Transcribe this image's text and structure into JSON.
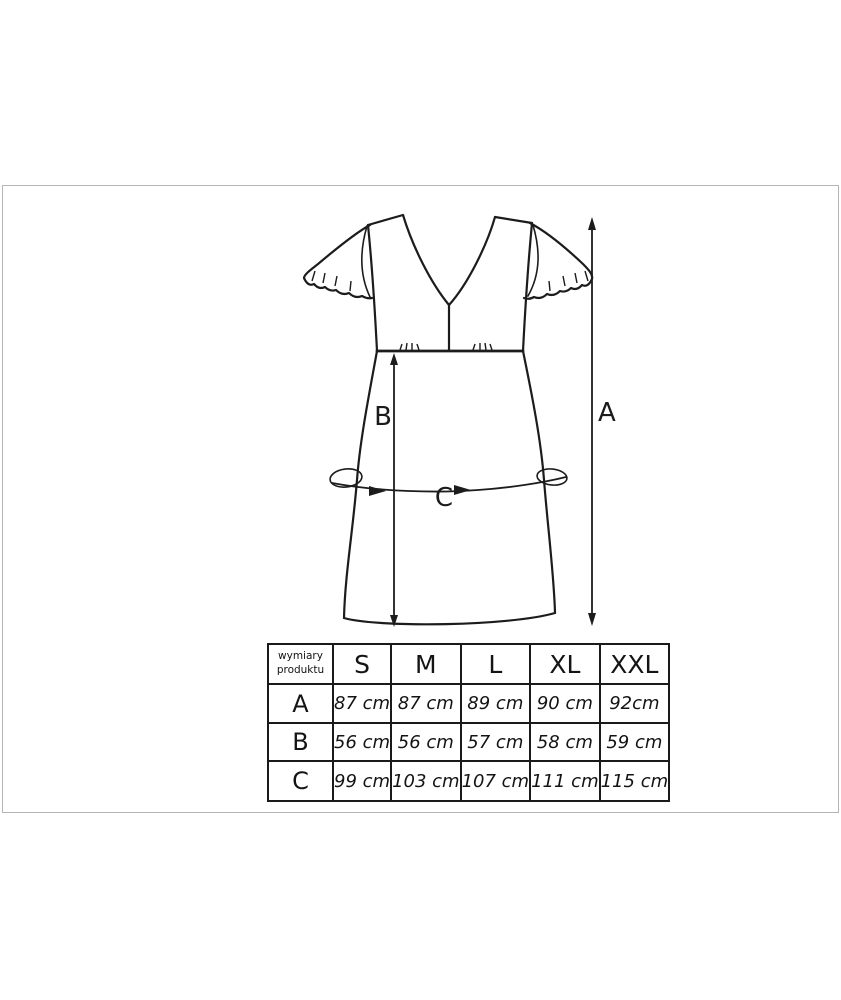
{
  "colors": {
    "background": "#ffffff",
    "frame_border": "#b5b5b5",
    "drawing_line": "#1c1c1c",
    "table_border": "#1a1a1a",
    "text": "#141414"
  },
  "product_diagram": {
    "garment": "short-sleeve v-neck empire-waist dress sketch",
    "measurement_labels": {
      "a": "A",
      "b": "B",
      "c": "C"
    }
  },
  "size_table": {
    "corner_header": "wymiary produktu",
    "size_headers": [
      "S",
      "M",
      "L",
      "XL",
      "XXL"
    ],
    "rows": [
      {
        "label": "A",
        "values": [
          "87 cm",
          "87 cm",
          "89 cm",
          "90 cm",
          "92cm"
        ]
      },
      {
        "label": "B",
        "values": [
          "56 cm",
          "56 cm",
          "57 cm",
          "58 cm",
          "59 cm"
        ]
      },
      {
        "label": "C",
        "values": [
          "99 cm",
          "103 cm",
          "107 cm",
          "111 cm",
          "115 cm"
        ]
      }
    ]
  }
}
